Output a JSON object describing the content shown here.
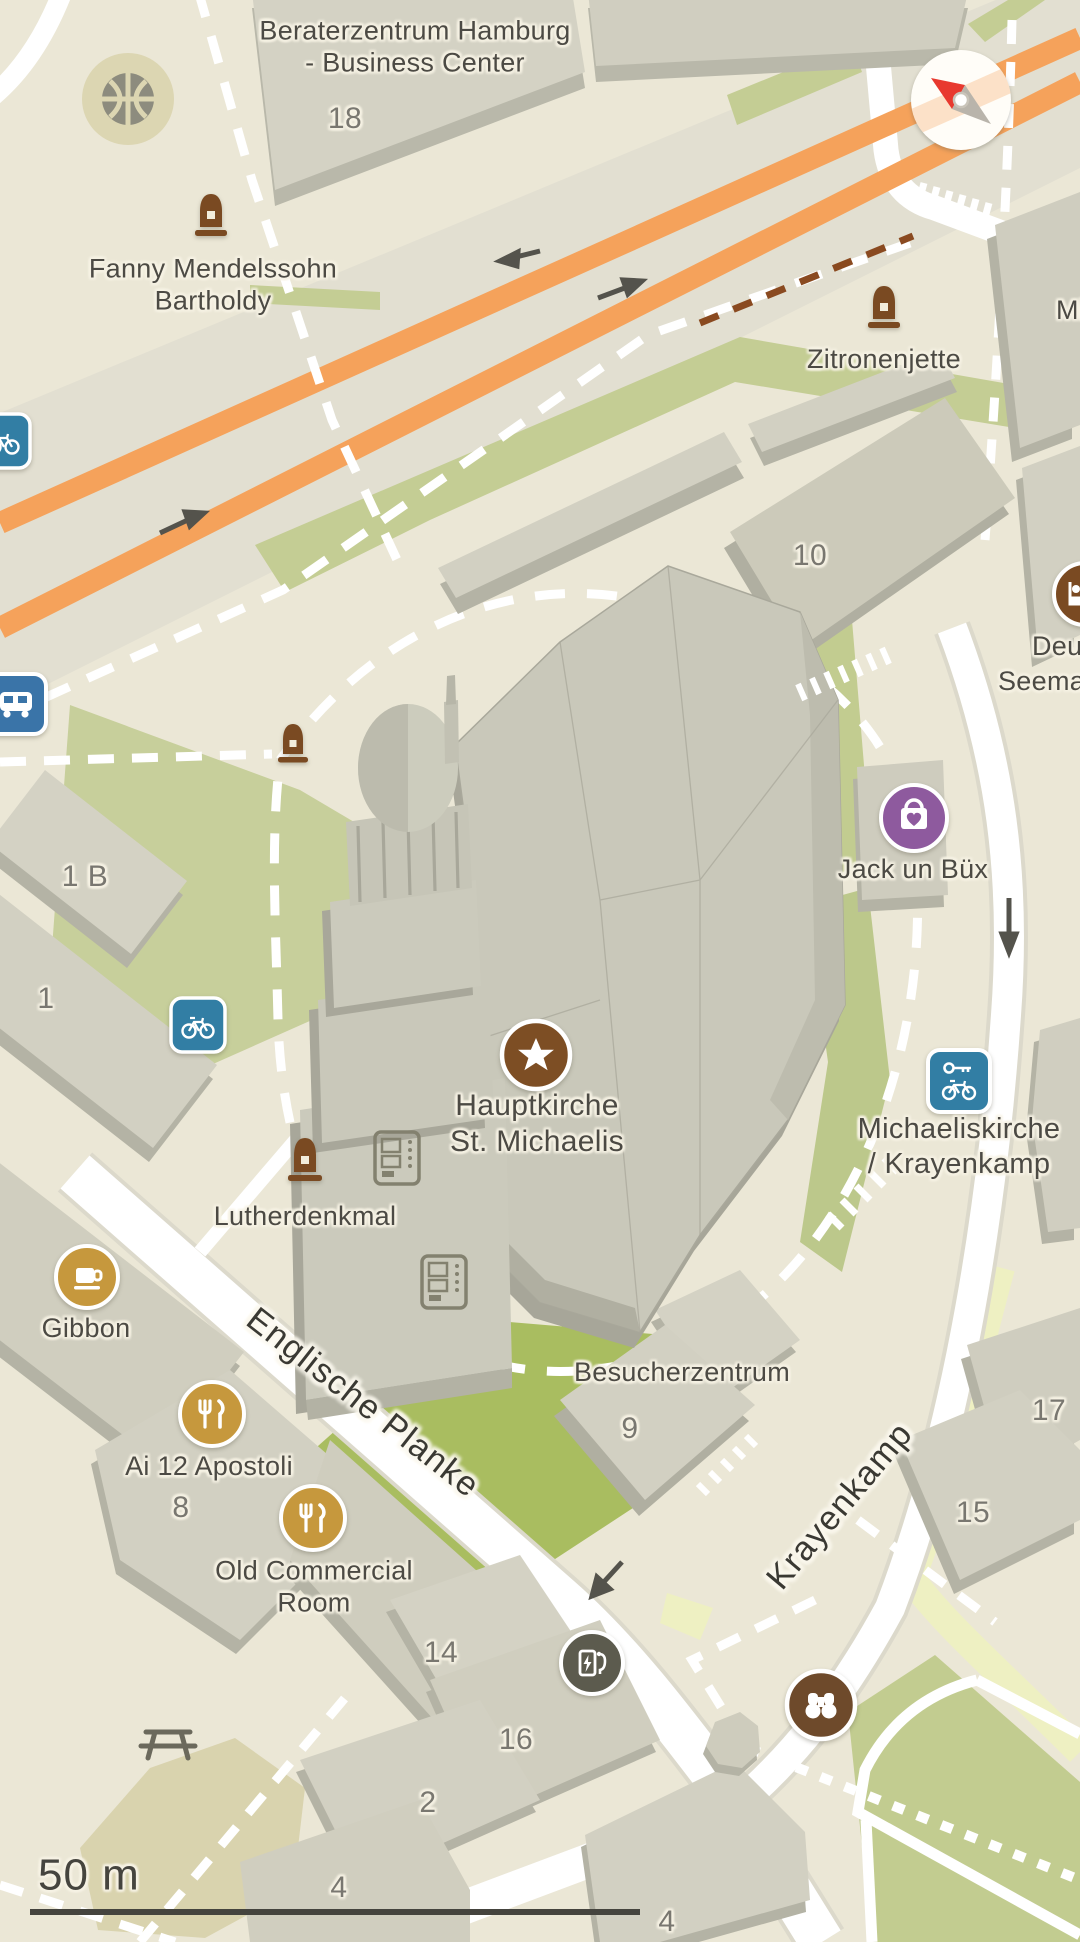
{
  "app": {
    "type": "map-view",
    "scale_label": "50 m"
  },
  "colors": {
    "plaza_cream": "#ebe7d6",
    "road_band_gray": "#e2dfd1",
    "road_white": "#ffffff",
    "highway_orange": "#f5a25b",
    "building_fill": "#d4d2c4",
    "building_side": "#b4b3a5",
    "church_fill": "#c9c8ba",
    "green_area": "#c6cf9b",
    "green_bright": "#a9bd60",
    "yellow_path": "#eef0c2",
    "khaki_area": "#dcd6b2",
    "poi_gold": "#c6983d",
    "poi_brown": "#7d4e24",
    "poi_purple": "#8e5a9e",
    "poi_blue": "#327ea4",
    "bus_blue": "#3a74a8",
    "charging_gray": "#5c5b4e",
    "binoculars_brown": "#6e4a2b",
    "monument_brown": "#7a4a22",
    "compass_red": "#e8392f",
    "label_dark": "#4c4a44"
  },
  "labels": {
    "beraterzentrum": "Beraterzentrum Hamburg\n- Business Center",
    "building_18": "18",
    "fanny_mendelssohn": "Fanny Mendelssohn\nBartholdy",
    "zitronenjette": "Zitronenjette",
    "street_truncated_mi": "Mi",
    "building_10": "10",
    "seemannsheim_line1": "Deut",
    "seemannsheim_line2": "Seemannsh",
    "jack_un_buex": "Jack un Büx",
    "building_1b": "1 B",
    "building_1": "1",
    "hauptkirche": "Hauptkirche\nSt. Michaelis",
    "michaeliskirche": "Michaeliskirche\n/ Krayenkamp",
    "lutherdenkmal": "Lutherdenkmal",
    "gibbon": "Gibbon",
    "englische_planke": "Englische Planke",
    "ai_12_apostoli": "Ai 12 Apostoli",
    "building_8": "8",
    "old_commercial_room": "Old Commercial\nRoom",
    "besucherzentrum": "Besucherzentrum",
    "building_9": "9",
    "krayenkamp": "Krayenkamp",
    "building_17": "17",
    "building_15": "15",
    "building_14": "14",
    "building_16": "16",
    "building_2": "2",
    "building_4_west": "4",
    "building_4_south": "4"
  },
  "icons": [
    {
      "name": "fountain-icon",
      "color": "#8d8c7e"
    },
    {
      "name": "monument-icon",
      "color": "#7a4a22"
    },
    {
      "name": "compass-icon",
      "color": "#e8392f"
    },
    {
      "name": "bicycle-parking-icon",
      "color": "#327ea4"
    },
    {
      "name": "bus-stop-icon",
      "color": "#3a74a8"
    },
    {
      "name": "hostel-icon",
      "color": "#7a4a22"
    },
    {
      "name": "shopping-heart-icon",
      "color": "#8e5a9e"
    },
    {
      "name": "church-star-icon",
      "color": "#7d4e24"
    },
    {
      "name": "bike-rental-icon",
      "color": "#327ea4"
    },
    {
      "name": "vending-machine-icon",
      "color": "#83816f"
    },
    {
      "name": "cafe-icon",
      "color": "#c6983d"
    },
    {
      "name": "restaurant-icon",
      "color": "#c6983d"
    },
    {
      "name": "ev-charging-icon",
      "color": "#5c5b4e"
    },
    {
      "name": "viewpoint-binoculars-icon",
      "color": "#6e4a2b"
    },
    {
      "name": "picnic-table-icon",
      "color": "#6b695c"
    }
  ]
}
